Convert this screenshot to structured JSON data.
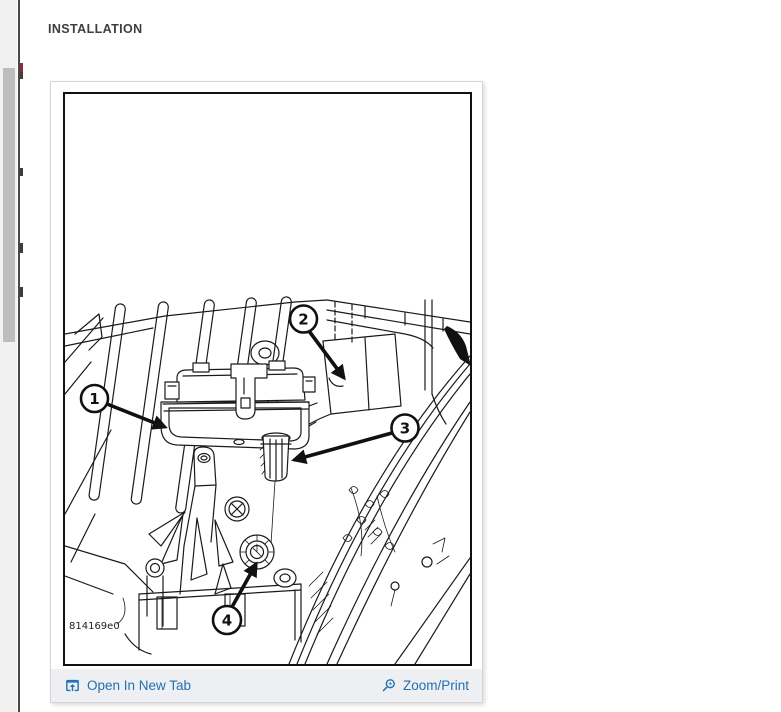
{
  "page": {
    "heading": "INSTALLATION"
  },
  "figure": {
    "part_number": "814169e0",
    "callouts": [
      {
        "number": "1"
      },
      {
        "number": "2"
      },
      {
        "number": "3"
      },
      {
        "number": "4"
      }
    ]
  },
  "toolbar": {
    "open_in_new_tab_label": "Open In New Tab",
    "zoom_print_label": "Zoom/Print"
  },
  "colors": {
    "link_blue": "#2270b3",
    "heading_text": "#3e3e3e",
    "toolbar_background": "#edeff2",
    "diagram_line": "#1a1a1a",
    "scrollbar_thumb": "#bdbdbd"
  }
}
